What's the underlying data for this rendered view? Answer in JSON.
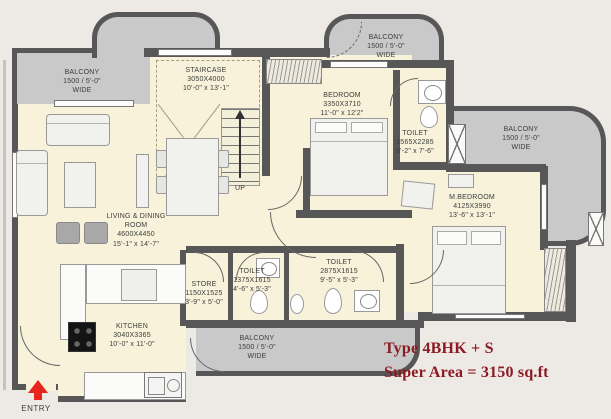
{
  "rooms": {
    "balcony_top_left": {
      "line1": "BALCONY",
      "line2": "1500 / 5'-0\"",
      "line3": "WIDE"
    },
    "balcony_top_right": {
      "line1": "BALCONY",
      "line2": "1500 / 5'-0\"",
      "line3": "WIDE"
    },
    "balcony_right": {
      "line1": "BALCONY",
      "line2": "1500 / 5'-0\"",
      "line3": "WIDE"
    },
    "balcony_bottom": {
      "line1": "BALCONY",
      "line2": "1500 / 5'-0\"",
      "line3": "WIDE"
    },
    "staircase": {
      "line1": "STAIRCASE",
      "line2": "3050X4000",
      "line3": "10'-0\" x 13'-1\""
    },
    "bedroom": {
      "line1": "BEDROOM",
      "line2": "3350X3710",
      "line3": "11'-0\" x 12'2\""
    },
    "toilet_bedroom": {
      "line1": "TOILET",
      "line2": "1565X2285",
      "line3": "5'-2\" x 7'-6\""
    },
    "master_bedroom": {
      "line1": "M.BEDROOM",
      "line2": "4125X3990",
      "line3": "13'-6\" x 13'-1\""
    },
    "living_dining": {
      "line1": "LIVING & DINING",
      "line2": "ROOM",
      "line3": "4600X4450",
      "line4": "15'-1\" x 14'-7\""
    },
    "store": {
      "line1": "STORE",
      "line2": "1150X1525",
      "line3": "3'-9\" x 5'-0\""
    },
    "toilet_small": {
      "line1": "TOILET",
      "line2": "1375X1615",
      "line3": "4'-6\" x 5'-3\""
    },
    "toilet_common": {
      "line1": "TOILET",
      "line2": "2875X1615",
      "line3": "9'-5\" x 5'-3\""
    },
    "kitchen": {
      "line1": "KITCHEN",
      "line2": "3040X3365",
      "line3": "10'-0\" x 11'-0\""
    }
  },
  "annotations": {
    "up": "UP",
    "entry": "ENTRY"
  },
  "title": {
    "line1": "Type 4BHK + S",
    "line2": "Super Area = 3150 sq.ft"
  },
  "colors": {
    "floor": "#f7f2d9",
    "balcony": "#c9c9c9",
    "wall": "#575757",
    "background": "#edeae6",
    "title_red": "#8c1a23",
    "entry_arrow_red": "#e8251d"
  }
}
